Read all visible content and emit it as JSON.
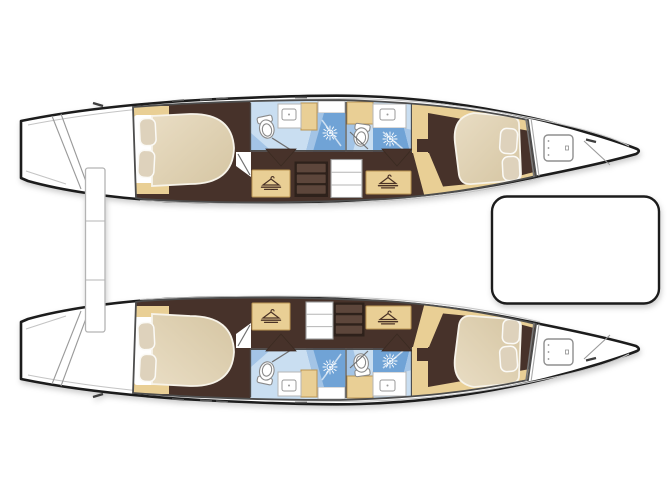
{
  "page": {
    "title": "Catamaran interior layout plan — top view",
    "image_type": "boat floor plan illustration",
    "background": "#ffffff"
  },
  "colors": {
    "outline": "#1c1c1c",
    "floor": "#46332a",
    "wood": "#e9cf95",
    "woodEdge": "#bb9553",
    "mattressLight": "#e9ddc4",
    "mattressDark": "#d5c5a2",
    "pillow": "#ded2bc",
    "bathFloor": "#c9def1",
    "bathMid": "#a3c4e6",
    "shower": "#6fa3d6",
    "wall": "#4d4d4d",
    "deckLine": "#c4c4c4",
    "hatchOutline": "#8f8f8f",
    "drawerDark": "#2e211b",
    "drawerFace": "#5d463b",
    "stepsOutline": "#9a9a9a",
    "doorLine": "#6f6f6f",
    "sunIcon": "#ffffff",
    "hangerIcon": "#4a3226",
    "toiletOutline": "#8a8a8a"
  },
  "boat": {
    "type": "catamaran",
    "view": "top-down deck plan",
    "orientation": {
      "bow": "right",
      "stern": "left"
    },
    "hulls": [
      {
        "name": "port-hull",
        "position": "top",
        "rooms": [
          {
            "name": "transom-steps",
            "features": [
              "stern boarding steps"
            ]
          },
          {
            "name": "aft-cabin",
            "features": [
              "double-berth",
              "two-pillows",
              "side-shelves"
            ]
          },
          {
            "name": "aft-bathroom",
            "features": [
              "toilet",
              "sink-counter",
              "shower"
            ]
          },
          {
            "name": "companionway",
            "features": [
              "steps",
              "drawer-unit",
              "wardrobe",
              "wardrobe"
            ]
          },
          {
            "name": "forward-bathroom",
            "features": [
              "toilet",
              "sink-counter",
              "shower"
            ]
          },
          {
            "name": "forward-cabin",
            "features": [
              "double-berth",
              "two-pillows"
            ]
          },
          {
            "name": "forepeak",
            "features": [
              "deck-hatch"
            ]
          }
        ]
      },
      {
        "name": "starboard-hull",
        "position": "bottom",
        "rooms": [
          {
            "name": "transom-steps",
            "features": [
              "stern boarding steps"
            ]
          },
          {
            "name": "aft-cabin",
            "features": [
              "double-berth",
              "two-pillows",
              "side-shelves"
            ]
          },
          {
            "name": "aft-bathroom",
            "features": [
              "toilet",
              "sink-counter",
              "shower"
            ]
          },
          {
            "name": "companionway",
            "features": [
              "steps",
              "drawer-unit",
              "wardrobe",
              "wardrobe"
            ]
          },
          {
            "name": "forward-bathroom",
            "features": [
              "toilet",
              "sink-counter",
              "shower"
            ]
          },
          {
            "name": "forward-cabin",
            "features": [
              "double-berth",
              "two-pillows"
            ]
          },
          {
            "name": "forepeak",
            "features": [
              "deck-hatch"
            ]
          }
        ]
      }
    ],
    "shared_structures": [
      {
        "name": "stern-crossbeam-platform",
        "position": "aft between hulls"
      },
      {
        "name": "foredeck-platform",
        "position": "forward between hulls"
      }
    ]
  },
  "icons": {
    "shower_head": "sunburst-icon",
    "wardrobe": "clothes-hanger-icon"
  },
  "counts": {
    "cabins": 4,
    "bathrooms": 4,
    "berths": 4,
    "toilets": 4,
    "showers": 4,
    "sinks": 4,
    "wardrobes": 4,
    "deck_hatches": 2
  }
}
